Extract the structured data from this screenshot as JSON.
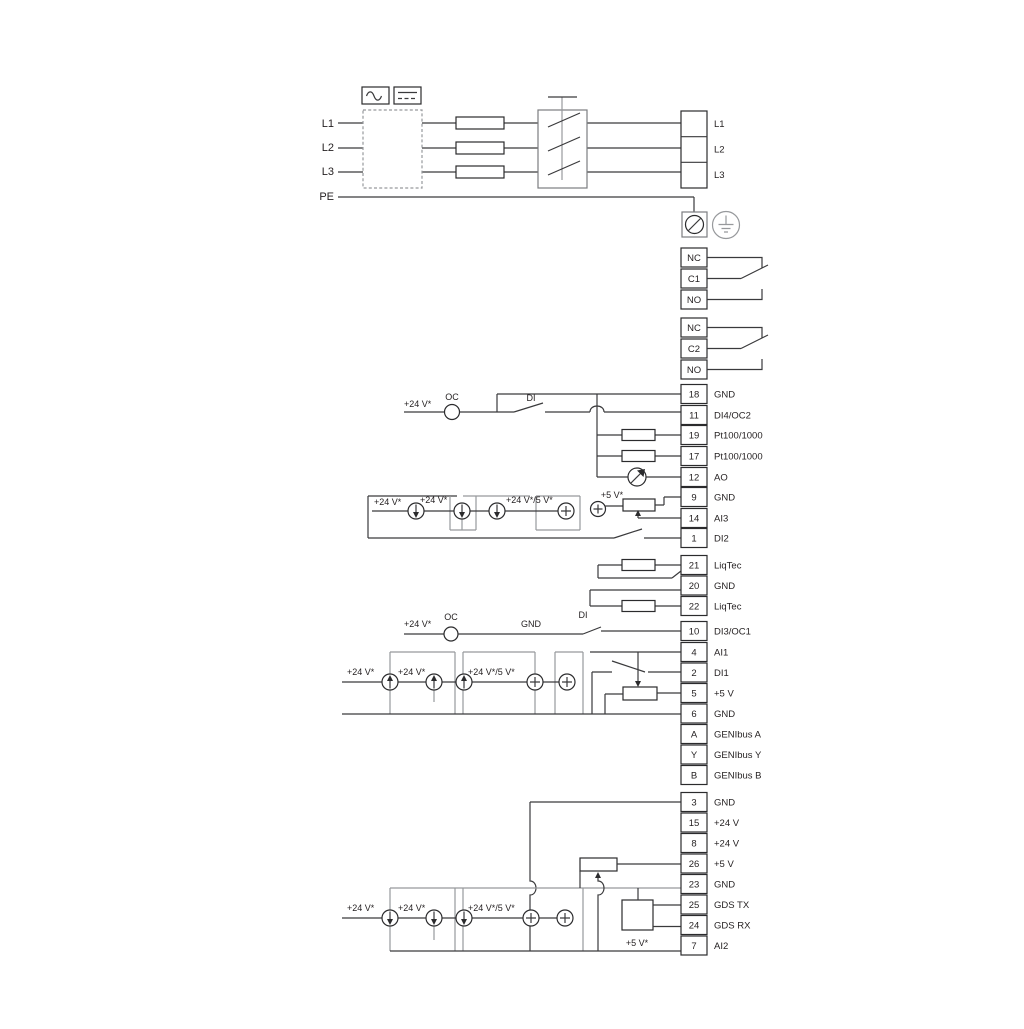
{
  "power": {
    "input_labels": [
      "L1",
      "L2",
      "L3",
      "PE"
    ],
    "output_labels": [
      "L1",
      "L2",
      "L3"
    ]
  },
  "relays": {
    "relay1": [
      "NC",
      "C1",
      "NO"
    ],
    "relay2": [
      "NC",
      "C2",
      "NO"
    ]
  },
  "io_top": [
    {
      "num": "18",
      "label": "GND"
    },
    {
      "num": "11",
      "label": "DI4/OC2"
    },
    {
      "num": "19",
      "label": "Pt100/1000"
    },
    {
      "num": "17",
      "label": "Pt100/1000"
    },
    {
      "num": "12",
      "label": "AO"
    },
    {
      "num": "9",
      "label": "GND"
    },
    {
      "num": "14",
      "label": "AI3"
    },
    {
      "num": "1",
      "label": "DI2"
    }
  ],
  "liqtec": [
    {
      "num": "21",
      "label": "LiqTec"
    },
    {
      "num": "20",
      "label": "GND"
    },
    {
      "num": "22",
      "label": "LiqTec"
    }
  ],
  "io_mid": [
    {
      "num": "10",
      "label": "DI3/OC1"
    },
    {
      "num": "4",
      "label": "AI1"
    },
    {
      "num": "2",
      "label": "DI1"
    },
    {
      "num": "5",
      "label": "+5 V"
    },
    {
      "num": "6",
      "label": "GND"
    },
    {
      "num": "A",
      "label": "GENIbus A"
    },
    {
      "num": "Y",
      "label": "GENIbus Y"
    },
    {
      "num": "B",
      "label": "GENIbus B"
    }
  ],
  "io_bottom": [
    {
      "num": "3",
      "label": "GND"
    },
    {
      "num": "15",
      "label": "+24 V"
    },
    {
      "num": "8",
      "label": "+24 V"
    },
    {
      "num": "26",
      "label": "+5 V"
    },
    {
      "num": "23",
      "label": "GND"
    },
    {
      "num": "25",
      "label": "GDS TX"
    },
    {
      "num": "24",
      "label": "GDS RX"
    },
    {
      "num": "7",
      "label": "AI2"
    }
  ],
  "annotations": {
    "oc_row1": {
      "v24": "+24 V*",
      "oc": "OC",
      "di": "DI"
    },
    "ai3_row": {
      "v24a": "+24 V*",
      "v24b": "+24 V*",
      "v24_5": "+24 V*/5 V*",
      "v5": "+5 V*"
    },
    "oc_row2": {
      "v24": "+24 V*",
      "oc": "OC",
      "gnd": "GND",
      "di": "DI"
    },
    "ai1_row": {
      "v24a": "+24 V*",
      "v24b": "+24 V*",
      "v24_5": "+24 V*/5 V*"
    },
    "ai2_row": {
      "v24a": "+24 V*",
      "v24b": "+24 V*",
      "v24_5": "+24 V*/5 V*",
      "v5": "+5 V*"
    }
  },
  "colors": {
    "wire": "#3a3a3c",
    "wire_gray": "#97999c",
    "text": "#231f20",
    "background": "#ffffff"
  }
}
